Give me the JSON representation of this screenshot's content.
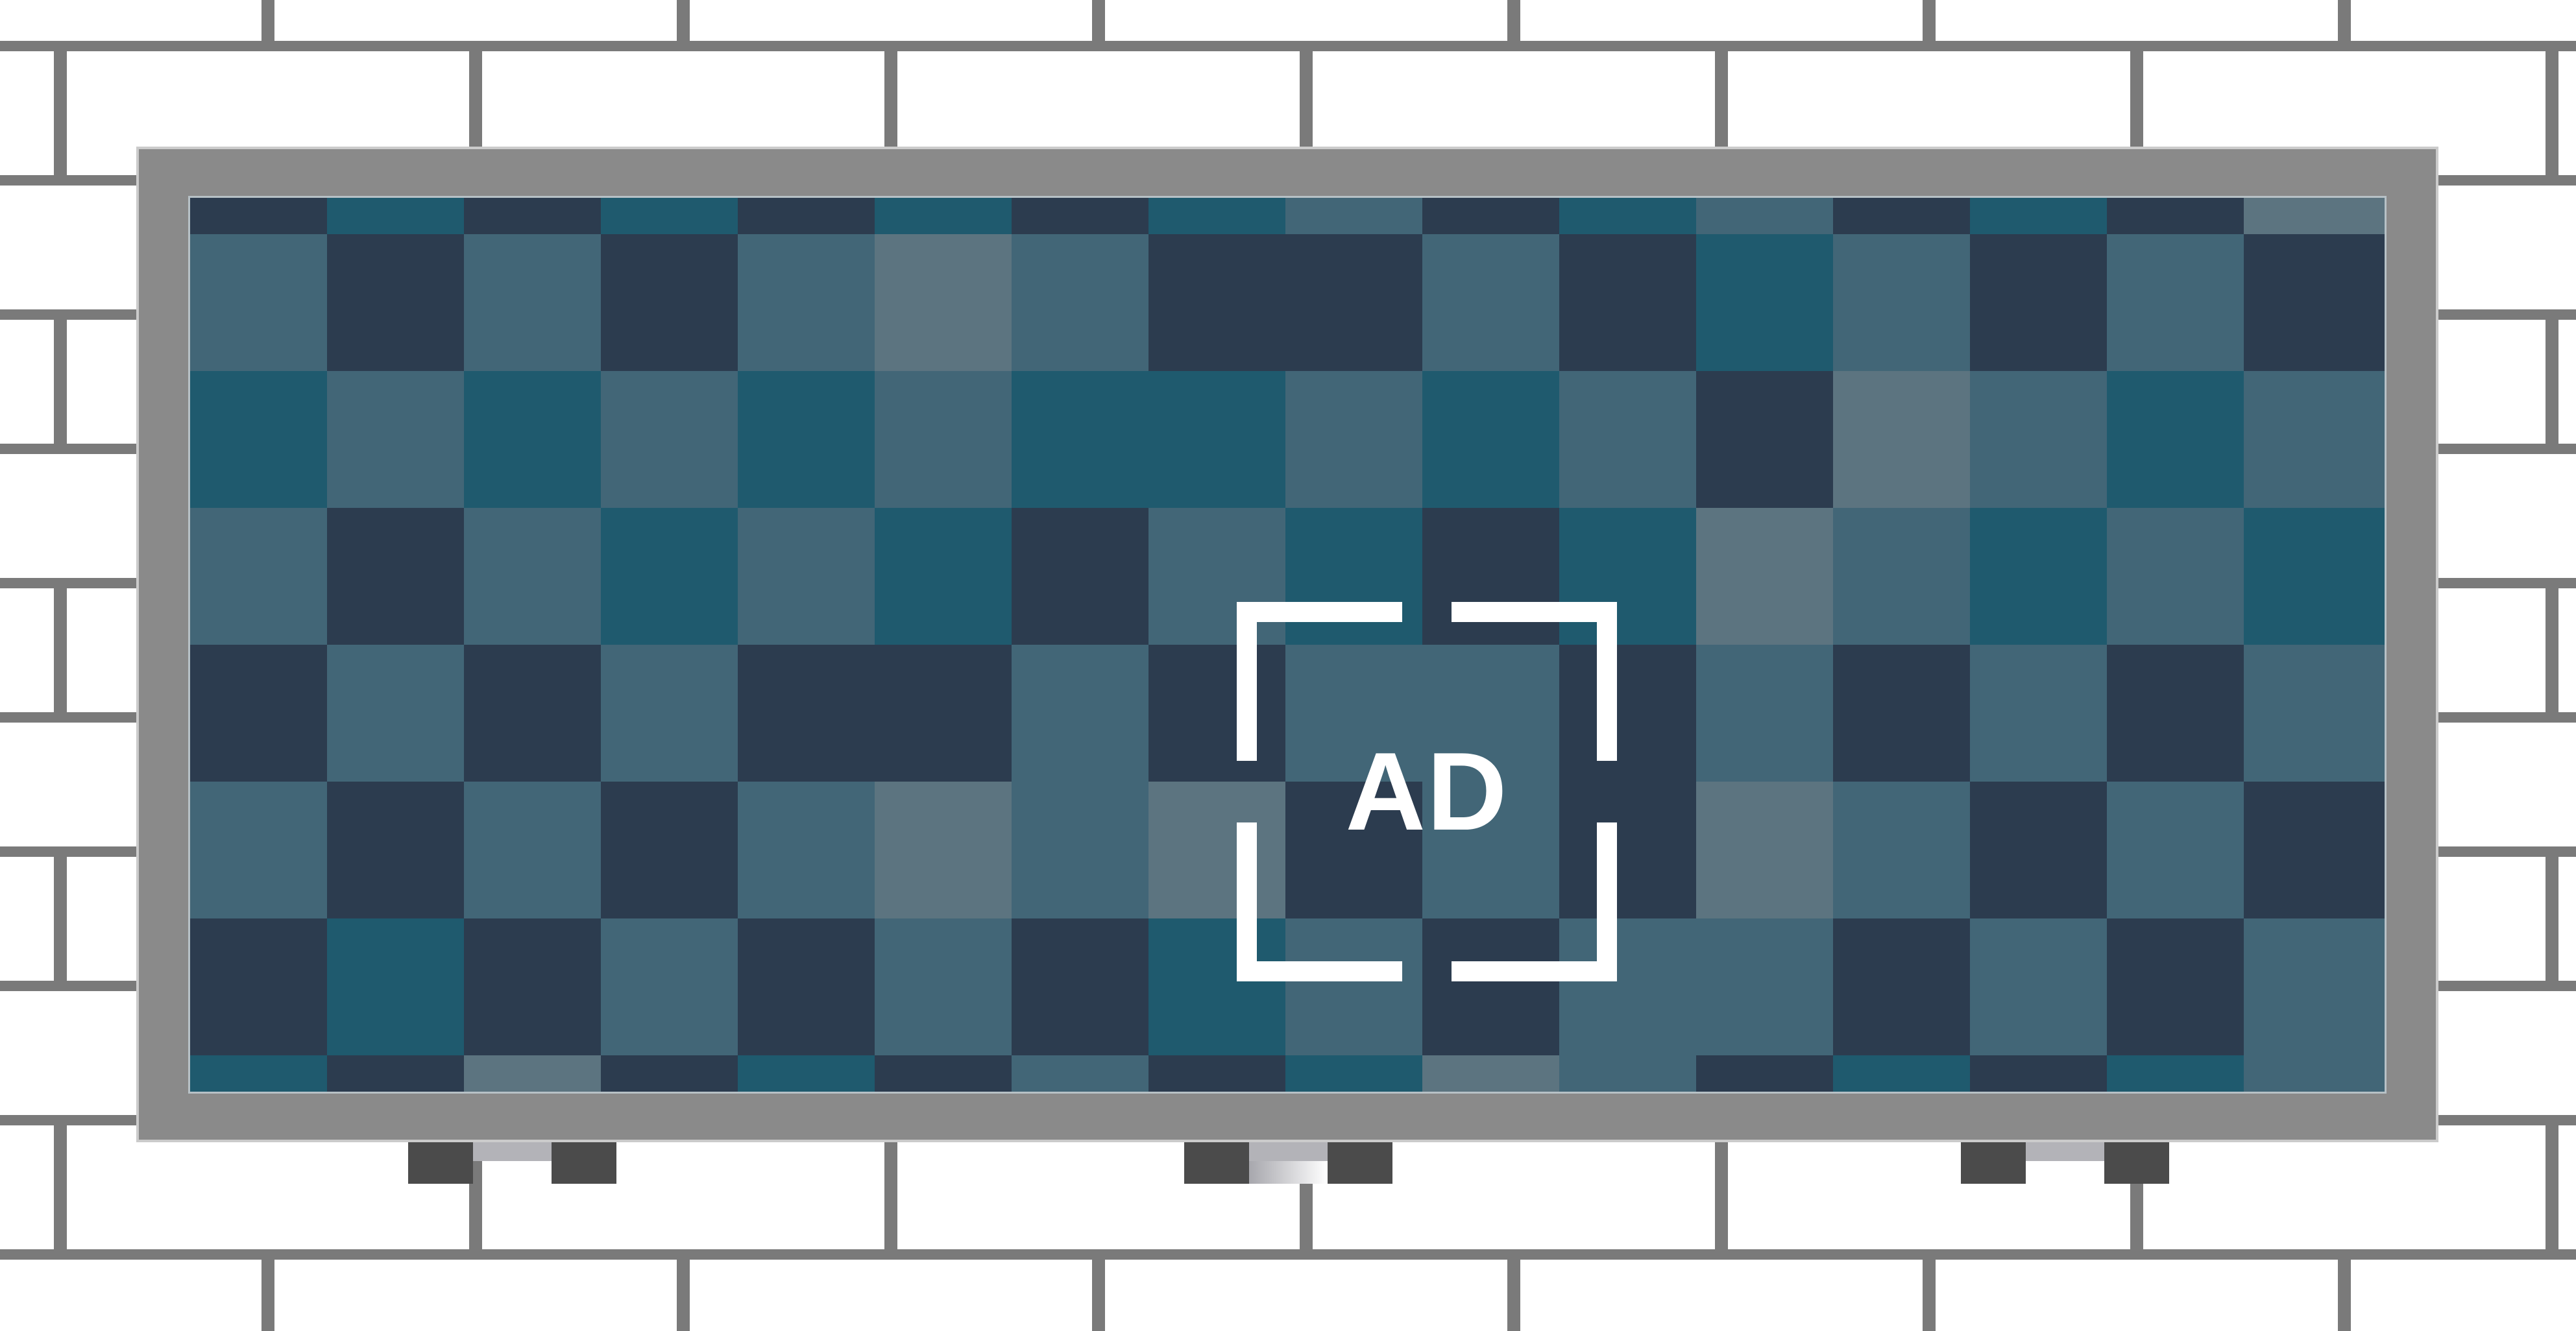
{
  "illustration": {
    "ad_label": "AD",
    "colors": {
      "brick": "#ffffff",
      "mortar": "#7a7a7a",
      "frame": "#8a8a8a",
      "frame_outline": "#cbcbcb",
      "screen_bezel": "#b7c1c6",
      "bracket_white": "#ffffff",
      "checker_dark_navy": "#2c3c4f",
      "checker_teal": "#1f5a6e",
      "checker_slate": "#426677",
      "checker_light_slate": "#5c7480",
      "foot_dark": "#4b4b4b",
      "foot_gray": "#b3b3b8",
      "foot_silver_start": "#a7a7ad",
      "foot_silver_end": "#ffffff"
    },
    "checker": {
      "legend": {
        "D": "dark navy",
        "T": "teal",
        "S": "slate",
        "L": "light slate"
      },
      "rows": [
        "DTDTDTDTSDTSDTDL",
        "SDSDSLSDDSDTSDSD",
        "TSTSTSTTSTSDLSTS",
        "SDSTSTDSTDTLSTST",
        "DSDSDDSDSSDSDSDS",
        "SDSDSLSLDSDLSDSD",
        "DTDSDSDTSDSSDSDS",
        "TDLDTDSDTLSDTDTS"
      ]
    }
  }
}
